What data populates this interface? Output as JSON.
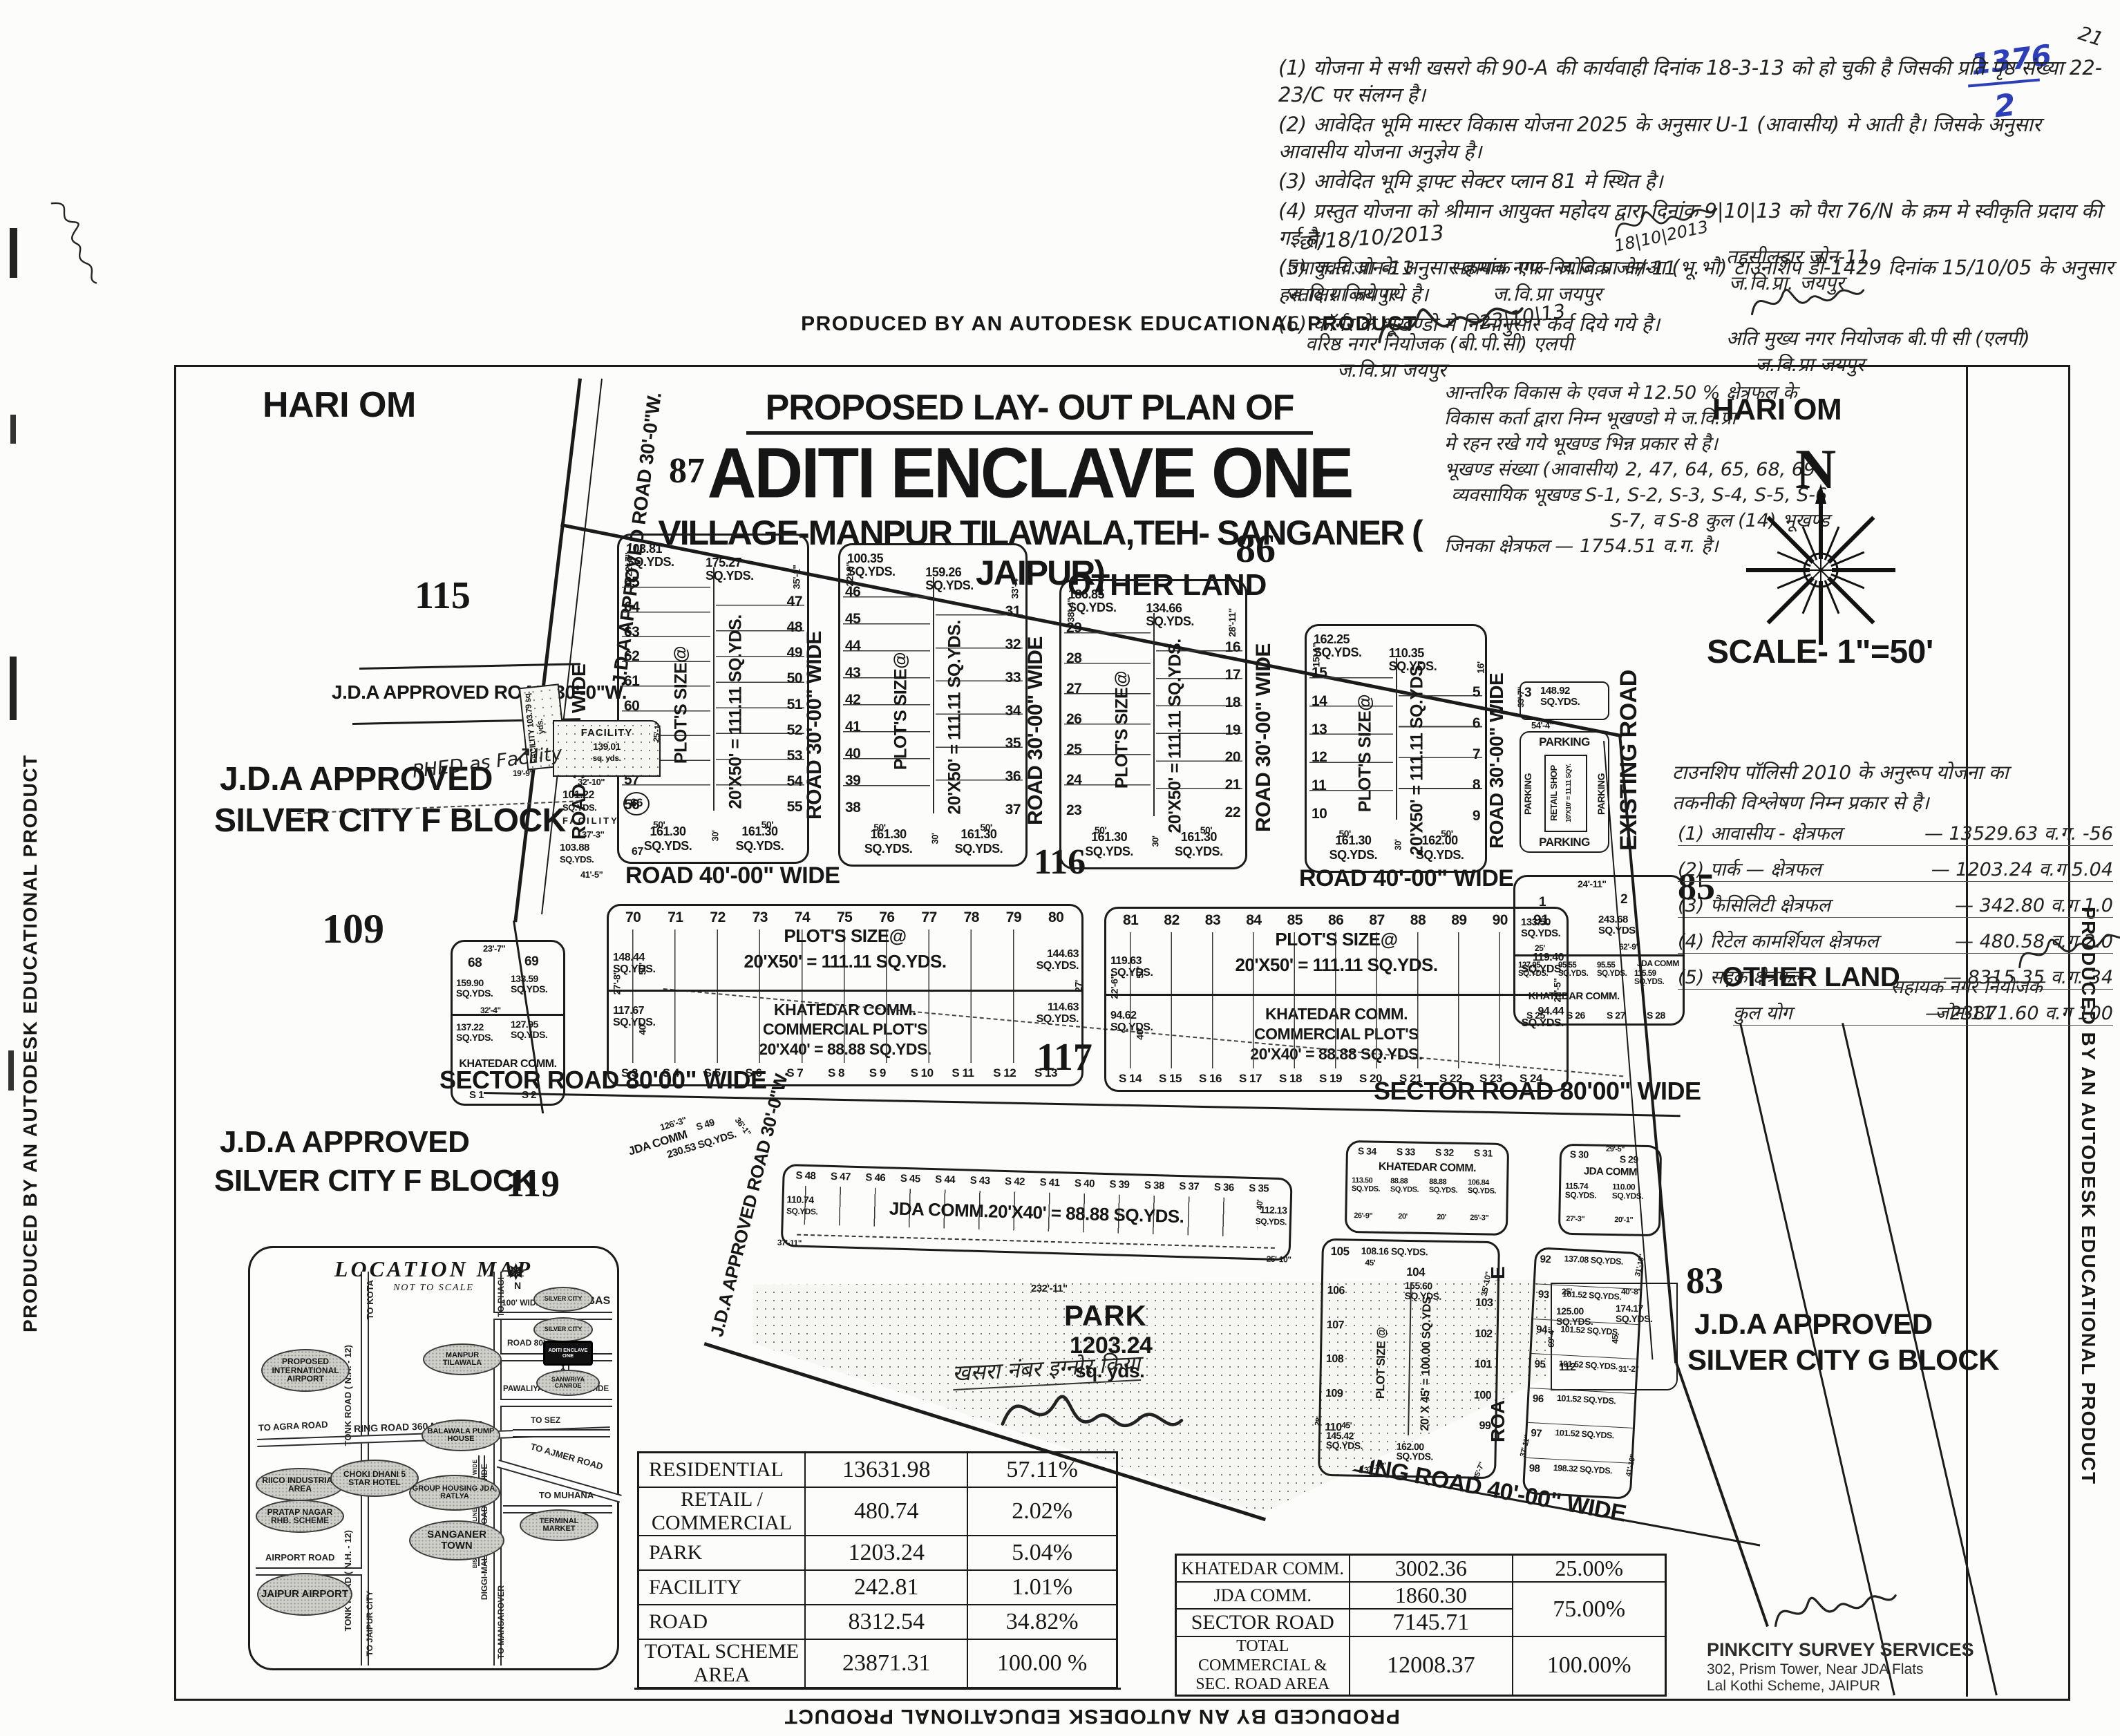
{
  "edge": {
    "autodesk": "PRODUCED BY AN AUTODESK EDUCATIONAL PRODUCT"
  },
  "corner": {
    "stamp_top": "1376",
    "stamp_bottom": "2",
    "corner_mark": "21"
  },
  "notes": {
    "lines": [
      "(1) योजना मे सभी खसरो की 90-A की कार्यवाही दिनांक 18-3-13 को हो चुकी है जिसकी प्रति पृष्ठ संख्या 22-23/C पर संलग्न है।",
      "(2) आवेदित भूमि मास्टर विकास योजना 2025 के अनुसार U-1 (आवासीय) मे आती है। जिसके अनुसार आवासीय योजना अनुज्ञेय है।",
      "(3) आवेदित भूमि ड्राफ्ट सेक्टर प्लान 81 मे स्थित है।",
      "(4) प्रस्तुत योजना को श्रीमान आयुक्त महोदय द्वारा दिनांक 9|10|13 को पैरा 76/N के क्रम मे स्वीकृति प्रदाय की गई है।",
      "(5) ज.वि.प्रा के अनुसार क्रमांक एफ- ज.वि.प्रा अ/आ (भू.भौ) टाउनशिप डी-1429 दिनांक 15/10/05 के अनुसार हस्ताक्षर किये गये है।",
      "(6) कॉर्नर के भूखण्डो मे निम्नानुसार कर्व दिये गये है।"
    ],
    "date1": "छो/18/10/2013",
    "sig_date_mid": "18|10|2013",
    "left_post1": "उपायुक्त जोन-11",
    "left_post2": "ज.वि.प्रा जयपुर",
    "mid_post1": "सहायक नगर नियोजक जोन-11",
    "mid_post2": "ज.वि.प्रा जयपुर",
    "sig_date2": "23|10|13",
    "senior_post1": "वरिष्ठ नगर नियोजक (बी.पी.सी) एलपी",
    "senior_post2": "ज.वि.प्रा जयपुर",
    "teh_post1": "तहसीलदार जोन-11",
    "teh_post2": "ज.वि.प्रा. जयपुर",
    "chief_post1": "अति मुख्य नगर नियोजक बी.पी सी (एलपी)",
    "chief_post2": "ज.वि.प्रा जयपुर"
  },
  "title": {
    "line1": "PROPOSED LAY- OUT PLAN OF",
    "line2": "ADITI ENCLAVE ONE",
    "line3": "VILLAGE-MANPUR TILAWALA,TEH- SANGANER ( JAIPUR)"
  },
  "side_note": {
    "lines": [
      "आन्तरिक विकास के एवज मे 12.50 % क्षेत्रफल के",
      "विकास कर्ता द्वारा निम्न भूखण्डो मे ज.वि.प्रा",
      "मे रहन रखे गये भूखण्ड भिन्न प्रकार से है।",
      "भूखण्ड संख्या (आवासीय) 2, 47, 64, 65, 68, 69",
      "व्यवसायिक भूखण्ड  S-1, S-2, S-3, S-4, S-5, S-6",
      "S-7, व S-8 कुल (14) भूखण्ड",
      "जिनका क्षेत्रफल  —  1754.51 व.ग. है।"
    ]
  },
  "policy_note": {
    "head1": "टाउनशिप पॉलिसी 2010 के अनुरूप योजना का",
    "head2": "तकनीकी विश्लेषण निम्न प्रकार से है।",
    "items": [
      {
        "name": "(1) आवासीय - क्षेत्रफल",
        "value": "— 13529.63 व.ग.",
        "pct": "-56"
      },
      {
        "name": "(2) पार्क — क्षेत्रफल",
        "value": "— 1203.24 व.ग",
        "pct": "5.04"
      },
      {
        "name": "(3) फैसिलिटी क्षेत्रफल",
        "value": "— 342.80 व.ग",
        "pct": "1.0"
      },
      {
        "name": "(4) रिटेल कामर्शियल क्षेत्रफल",
        "value": "— 480.58 व.ग",
        "pct": "2.0"
      },
      {
        "name": "(5) सड़क क्षेत्रफल",
        "value": "— 8315.35 व.ग.",
        "pct": "34"
      },
      {
        "name": "कुल योग",
        "value": "— 23871.60 व.ग",
        "pct": "100"
      }
    ],
    "officer1": "सहायक नगर नियोजक",
    "officer2": "जोन-11"
  },
  "labels": {
    "hari_om": "HARI OM",
    "other_land": "OTHER LAND",
    "scale": "SCALE- 1\"=50'",
    "north": "N",
    "jda_approved": "J.D.A APPROVED",
    "silver_f": "SILVER CITY F  BLOCK",
    "silver_g": "SILVER CITY G BLOCK",
    "n83": "83",
    "n85": "85",
    "n86": "86",
    "n87": "87",
    "n109": "109",
    "n115": "115",
    "n116": "116",
    "n117": "117",
    "n118": "118",
    "n119": "119",
    "khasra_note": "खसरा नंबर इग्नोर किया",
    "phed_note": "PHED as Facility",
    "arrow": "↗"
  },
  "roads": {
    "r30": "ROAD 30'-00\" WIDE",
    "r40": "ROAD 40'-00\" WIDE",
    "sector": "SECTOR ROAD 80'00\" WIDE",
    "existing": "EXISTING ROAD",
    "existing40": "EXISTING ROAD 40'-00\" WIDE",
    "jda30": "J.D.A APPROVED ROAD 30'-0\"W."
  },
  "strips": [
    {
      "left": [
        "65",
        "64",
        "63",
        "62",
        "61",
        "60",
        "59",
        "58",
        "57",
        "56"
      ],
      "right": [
        "47",
        "48",
        "49",
        "50",
        "51",
        "52",
        "53",
        "54",
        "55"
      ],
      "top_areas": [
        "103.81 SQ.YDS.",
        "175.27 SQ.YDS."
      ],
      "size1": "PLOT'S SIZE@",
      "size2": "20'X50' = 111.11 SQ.YDS.",
      "bottom": [
        "161.30 SQ.YDS.",
        "161.30 SQ.YDS."
      ],
      "dims": [
        "22'-7\"",
        "35'-1\"",
        "15'-6\"",
        "28'",
        "50'",
        "30'"
      ]
    },
    {
      "left": [
        "46",
        "45",
        "44",
        "43",
        "42",
        "41",
        "40",
        "39",
        "38"
      ],
      "right": [
        "31",
        "32",
        "33",
        "34",
        "35",
        "36",
        "37"
      ],
      "top_areas": [
        "100.35 SQ.YDS.",
        "159.26 SQ.YDS."
      ],
      "size1": "PLOT'S SIZE@",
      "size2": "20'X50' = 111.11 SQ.YDS.",
      "bottom": [
        "161.30 SQ.YDS.",
        "161.30 SQ.YDS."
      ],
      "dims": [
        "22'-9\"",
        "33'-4\"",
        "13'-4\"",
        "24'",
        "50'",
        "30'"
      ]
    },
    {
      "left": [
        "29",
        "28",
        "27",
        "26",
        "25",
        "24",
        "23"
      ],
      "right": [
        "16",
        "17",
        "18",
        "19",
        "20",
        "21",
        "22"
      ],
      "top_areas": [
        "186.85 SQ.YDS.",
        "134.66 SQ.YDS."
      ],
      "size1": "PLOT'S SIZE@",
      "size2": "20'X50' = 111.11 SQ.YDS.",
      "bottom": [
        "161.30 SQ.YDS.",
        "161.30 SQ.YDS."
      ],
      "dims": [
        "38'-4\"",
        "28'-11\"",
        "19'-6\"",
        "16'",
        "50'",
        "30'"
      ]
    },
    {
      "left": [
        "15",
        "14",
        "13",
        "12",
        "11",
        "10"
      ],
      "right": [
        "5",
        "6",
        "7",
        "8",
        "9"
      ],
      "top_areas": [
        "162.25 SQ.YDS.",
        "110.35 SQ.YDS."
      ],
      "size1": "PLOT'S SIZE@",
      "size2": "20'X50' = 111.11 SQ.YDS.",
      "bottom": [
        "161.30 SQ.YDS.",
        "162.00 SQ.YDS."
      ],
      "dims": [
        "15'-1\"",
        "16'",
        "28'-1\"",
        "10'",
        "50'",
        "30'"
      ]
    }
  ],
  "parking": {
    "plot": "3",
    "area": "148.92 SQ.YDS.",
    "label": "PARKING",
    "retail1": "RETAIL SHOP",
    "retail2": "10'X10' = 11.11 SQY.",
    "dim1": "54'-4\"",
    "dim2": "33'-7\""
  },
  "facility": {
    "f1a": "FACILITY",
    "f1b": "103.79 sq. yds.",
    "f2a": "FACILITY",
    "f2b": "139.01",
    "f2c": "sq. yds.",
    "d1": "32'-10\"",
    "p66a": "101.22",
    "p66b": "SQ.YDS.",
    "p66": "66",
    "p66c": "FACILITY",
    "d2": "37'-3\"",
    "p67a": "103.88",
    "p67b": "SQ.YDS.",
    "p67": "67",
    "d3": "41'-5\"",
    "d4": "25'-1\"",
    "d5": "19'-9\""
  },
  "midL": {
    "dtop": "23'-7\"",
    "n1": "68",
    "n2": "69",
    "a1": "159.90 SQ.YDS.",
    "a2": "133.59 SQ.YDS.",
    "a3": "137.22 SQ.YDS.",
    "a4": "127.95 SQ.YDS.",
    "label": "KHATEDAR COMM.",
    "s1": "S 1",
    "s2": "S 2",
    "d1": "32'-4\"",
    "d2": "27'-4\"",
    "d3": "50'",
    "d4": "40'"
  },
  "blockL": {
    "top": [
      "70",
      "71",
      "72",
      "73",
      "74",
      "75",
      "76",
      "77",
      "78",
      "79",
      "80"
    ],
    "size1": "PLOT'S SIZE@",
    "size2": "20'X50' = 111.11 SQ.YDS.",
    "tl": "148.44 SQ.YDS.",
    "tr": "144.63 SQ.YDS.",
    "bl": "117.67 SQ.YDS.",
    "br": "114.63 SQ.YDS.",
    "c1": "KHATEDAR COMM.",
    "c2": "COMMERCIAL PLOT'S",
    "c3": "20'X40' = 88.88 SQ.YDS.",
    "bottom": [
      "S 3",
      "S 4",
      "S 5",
      "S 6",
      "S 7",
      "S 8",
      "S 9",
      "S 10",
      "S 11",
      "S 12",
      "S 13"
    ],
    "d1": "27'-8\"",
    "d2": "50'",
    "d3": "40'",
    "d4": "27'"
  },
  "blockR": {
    "top": [
      "81",
      "82",
      "83",
      "84",
      "85",
      "86",
      "87",
      "88",
      "89",
      "90",
      "91"
    ],
    "size1": "PLOT'S SIZE@",
    "size2": "20'X50' = 111.11 SQ.YDS.",
    "tl": "119.63 SQ.YDS.",
    "tr": "119.40 SQ.YDS.",
    "bl": "94.62 SQ.YDS.",
    "br": "94.44 SQ.YDS.",
    "c1": "KHATEDAR COMM.",
    "c2": "COMMERCIAL PLOT'S",
    "c3": "20'X40' = 88.88 SQ.YDS.",
    "bottom": [
      "S 14",
      "S 15",
      "S 16",
      "S 17",
      "S 18",
      "S 19",
      "S 20",
      "S 21",
      "S 22",
      "S 23",
      "S 24"
    ],
    "d1": "22'-6\"",
    "d2": "50'",
    "d3": "40'",
    "d4": "22'-5\""
  },
  "midR": {
    "dtop": "24'-11\"",
    "n1": "1",
    "a1": "133.50 SQ.YDS.",
    "n2": "2",
    "a2": "243.68 SQ.YDS.",
    "r1": "127.95 SQ.YDS.",
    "r2": "95.55 SQ.YDS.",
    "r3": "95.55 SQ.YDS.",
    "jda": "JDA COMM",
    "jda_a": "115.59 SQ.YDS.",
    "label": "KHATEDAR COMM.",
    "s": [
      "S 25",
      "S 26",
      "S 27",
      "S 28"
    ],
    "d1": "25'",
    "d2": "30'",
    "d3": "21'-6\"",
    "d4": "21'-6\"",
    "d5": "14'-9\"",
    "d6": "62'-9\""
  },
  "jdaSmall": {
    "label": "JDA COMM",
    "area": "230.53 SQ.YDS.",
    "s": "S 49",
    "d1": "126'-3\"",
    "d2": "36'-1\""
  },
  "jdaStrip": {
    "s": [
      "S 48",
      "S 47",
      "S 46",
      "S 45",
      "S 44",
      "S 43",
      "S 42",
      "S 41",
      "S 40",
      "S 39",
      "S 38",
      "S 37",
      "S 36",
      "S 35"
    ],
    "label": "JDA COMM.20'X40' = 88.88 SQ.YDS.",
    "la": "110.74",
    "laa": "SQ.YDS.",
    "ra": "112.13",
    "raa": "SQ.YDS.",
    "d1": "37'-11\"",
    "d2": "25'-10\"",
    "d3": "40'",
    "d4": "26'-8\""
  },
  "park": {
    "name": "PARK",
    "area": "1203.24",
    "unit": "sq. yds.",
    "dim": "232'-11\""
  },
  "parkSide": {
    "a1": "125.00 SQ.YDS.",
    "a2": "174.17 SQ.YDS.",
    "n": "112",
    "d1": "25'",
    "d2": "40'-8\"",
    "d3": "45'",
    "d4": "11'",
    "d5": "31'-2\"",
    "d6": "69'-4\""
  },
  "brKhatedar": {
    "s": [
      "S 34",
      "S 33",
      "S 32",
      "S 31"
    ],
    "label": "KHATEDAR COMM.",
    "areas": [
      "113.50 SQ.YDS.",
      "88.88 SQ.YDS.",
      "88.88 SQ.YDS.",
      "106.84 SQ.YDS."
    ],
    "d1": "26'-9\"",
    "d2": "20'",
    "d3": "20'",
    "d4": "25'-3\"",
    "d5": "40'"
  },
  "brJda": {
    "s": [
      "S 30",
      "S 29"
    ],
    "label": "JDA COMM",
    "areas": [
      "115.74 SQ.YDS.",
      "110.00 SQ.YDS."
    ],
    "d1": "29'-5\"",
    "d2": "27'-3\"",
    "d3": "20'-1\"",
    "d4": "40'"
  },
  "brRes": {
    "t1n": "105",
    "t1a": "108.16 SQ.YDS.",
    "t2n": "104",
    "t2a": "155.60 SQ.YDS.",
    "left": [
      "106",
      "107",
      "108",
      "109",
      "110"
    ],
    "right": [
      "103",
      "102",
      "101",
      "100",
      "99"
    ],
    "size1": "PLOT SIZE @",
    "size2": "20' X 45' = 100.00 SQ.YDS",
    "b1": "145.42 SQ.YDS.",
    "b2": "162.00 SQ.YDS.",
    "d1": "16'-11\"",
    "d2": "45'",
    "d3": "26'-5\"",
    "d4": "35'-10\"",
    "d5": "31'-10\"",
    "d6": "35'-7\"",
    "d7": "28'",
    "d8": "45'"
  },
  "brStrip": {
    "plots": [
      [
        "92",
        "137.08 SQ.YDS."
      ],
      [
        "93",
        "101.52 SQ.YDS."
      ],
      [
        "94",
        "101.52 SQ.YDS."
      ],
      [
        "95",
        "101.52 SQ.YDS."
      ],
      [
        "96",
        "101.52 SQ.YDS."
      ],
      [
        "97",
        "101.52 SQ.YDS."
      ],
      [
        "98",
        "198.32 SQ.YDS."
      ]
    ],
    "d1": "31'-10\"",
    "d2": "45'-8\"",
    "d3": "41'-10\"",
    "d4": "37'-11\""
  },
  "map": {
    "title": "LOCATION MAP",
    "subtitle": "NOT TO SCALE",
    "north": "N",
    "places": [
      "PROPOSED INTERNATIONAL AIRPORT",
      "RIICO INDUSTRIAL AREA",
      "PRATAP NAGAR RHB. SCHEME",
      "JAIPUR AIRPORT",
      "CHOKI DHANI 5 STAR HOTEL",
      "MANPUR TILAWALA",
      "BALAWALA PUMP HOUSE",
      "GROUP HOUSING JDA, RATLYA",
      "SANGANER TOWN",
      "TERMINAL MARKET",
      "SILVER CITY",
      "SILVER CITY",
      "SANWRIYA CANROE"
    ],
    "site": "ADITI ENCLAVE ONE",
    "roads": [
      "TO KOTA",
      "TONK ROAD ( N.H. - 12)",
      "TO AGRA ROAD",
      "RING ROAD 360 MTR. WIDE",
      "TONK ROAD ( N.H. - 12)",
      "AIRPORT ROAD",
      "TO JAIPUR CITY",
      "TO MANSAROVER",
      "DIGGI-MALPURA ROAD 300' WIDE",
      "TO PHAGI",
      "100' WIDE",
      "TO RUBAS",
      "ROAD 80' WIDE",
      "ROAD 60' W.",
      "PAWALIYA ROAD 100' WIDE",
      "TO SEZ",
      "TO AJMER ROAD",
      "TO MUHANA",
      "BISALPUR PIPE LINE ROAD 100' WIDE"
    ]
  },
  "table1": {
    "rows": [
      [
        "RESIDENTIAL",
        "13631.98",
        "57.11%"
      ],
      [
        "RETAIL / COMMERCIAL",
        "480.74",
        "2.02%"
      ],
      [
        "PARK",
        "1203.24",
        "5.04%"
      ],
      [
        "FACILITY",
        "242.81",
        "1.01%"
      ],
      [
        "ROAD",
        "8312.54",
        "34.82%"
      ],
      [
        "TOTAL SCHEME AREA",
        "23871.31",
        "100.00 %"
      ]
    ]
  },
  "table2": {
    "rows": [
      [
        "KHATEDAR COMM.",
        "3002.36"
      ],
      [
        "JDA COMM.",
        "1860.30"
      ],
      [
        "SECTOR ROAD",
        "7145.71"
      ],
      [
        "TOTAL COMMERCIAL & SEC. ROAD AREA",
        "12008.37"
      ]
    ],
    "pct1": "25.00%",
    "pct2": "75.00%",
    "pct3": "100.00%"
  },
  "surveyor": {
    "name": "PINKCITY SURVEY SERVICES",
    "addr1": "302, Prism Tower, Near JDA Flats",
    "addr2": "Lal Kothi Scheme, JAIPUR"
  }
}
